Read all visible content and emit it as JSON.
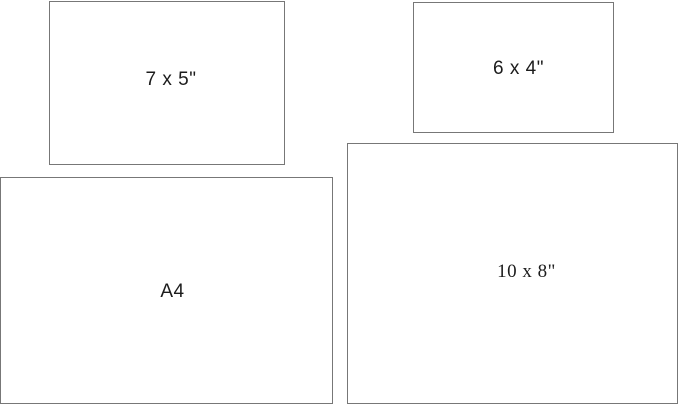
{
  "diagram": {
    "name": "print-size-comparison",
    "rectangles": [
      {
        "id": "7x5",
        "label": "7 x 5\""
      },
      {
        "id": "6x4",
        "label": "6 x 4\""
      },
      {
        "id": "a4",
        "label": "A4"
      },
      {
        "id": "10x8",
        "label": "10 x 8\""
      }
    ],
    "colors": {
      "background": "#ffffff",
      "border": "#777777",
      "text": "#1c1c1c"
    }
  }
}
